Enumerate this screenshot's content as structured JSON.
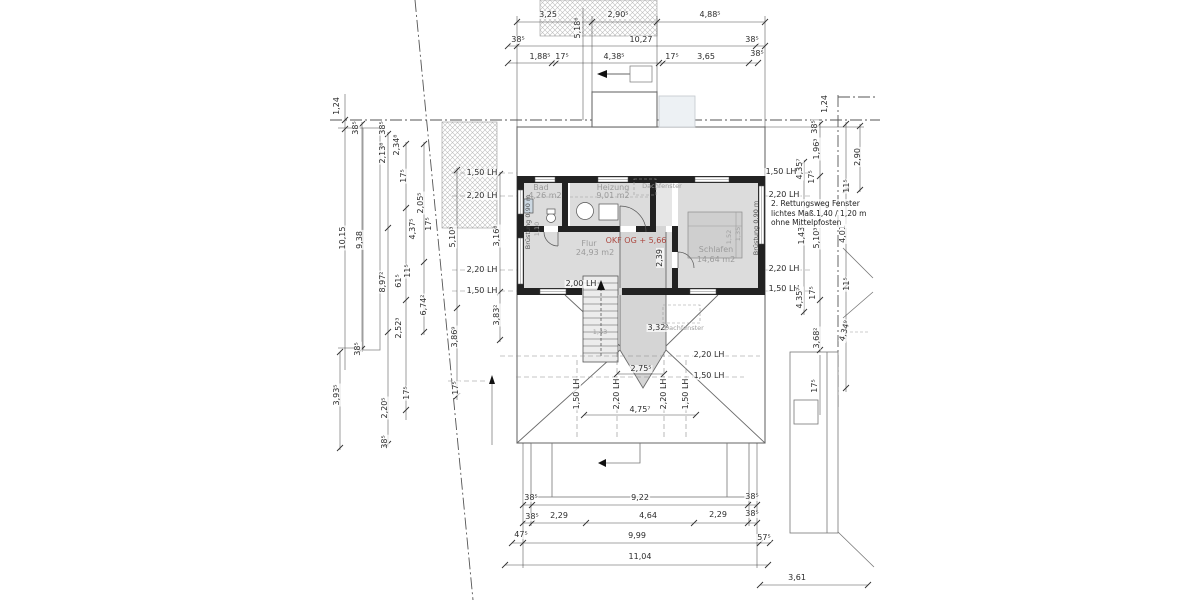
{
  "drawing": {
    "type": "floor-plan-obergeschoss",
    "level_marker": "OKF OG + 5,66",
    "rooms": [
      {
        "name": "Bad",
        "area": "4,26 m2"
      },
      {
        "name": "Heizung",
        "area": "9,01 m2"
      },
      {
        "name": "Flur",
        "area": "24,93 m2"
      },
      {
        "name": "Schlafen",
        "area": "14,64 m2"
      }
    ],
    "annotation": {
      "x": 771,
      "y": 199,
      "lines": [
        "2. Rettungsweg Fenster",
        "lichtes Maß.1,40 / 1,20 m",
        "ohne Mittelpfosten"
      ]
    }
  },
  "colors": {
    "line": "#4c4c4c",
    "wall": "#222222",
    "room_fill": "#dcdcdc",
    "level_red": "#ad4a42",
    "dim_text": "#2b2b2b",
    "room_text": "#9b9b9b"
  },
  "labels": [
    {
      "t": "3,25",
      "x": 548,
      "y": 15
    },
    {
      "t": "2,90⁵",
      "x": 618,
      "y": 15
    },
    {
      "t": "4,88⁵",
      "x": 710,
      "y": 15
    },
    {
      "t": "5,18⁶",
      "x": 578,
      "y": 28,
      "r": 90
    },
    {
      "t": "38⁵",
      "x": 518,
      "y": 40
    },
    {
      "t": "10,27",
      "x": 641,
      "y": 40
    },
    {
      "t": "38⁵",
      "x": 752,
      "y": 40
    },
    {
      "t": "1,88⁵",
      "x": 540,
      "y": 57
    },
    {
      "t": "17⁵",
      "x": 562,
      "y": 57
    },
    {
      "t": "4,38⁵",
      "x": 614,
      "y": 57
    },
    {
      "t": "17⁵",
      "x": 672,
      "y": 57
    },
    {
      "t": "3,65",
      "x": 706,
      "y": 57
    },
    {
      "t": "38⁵",
      "x": 757,
      "y": 54
    },
    {
      "t": "1,24",
      "x": 337,
      "y": 106,
      "r": 90
    },
    {
      "t": "38⁵",
      "x": 356,
      "y": 128,
      "r": 90
    },
    {
      "t": "38⁵",
      "x": 383,
      "y": 128,
      "r": 90
    },
    {
      "t": "2,13⁸",
      "x": 383,
      "y": 153,
      "r": 90
    },
    {
      "t": "2,34⁸",
      "x": 397,
      "y": 145,
      "r": 90
    },
    {
      "t": "17⁵",
      "x": 404,
      "y": 176,
      "r": 90
    },
    {
      "t": "2,05⁵",
      "x": 421,
      "y": 203,
      "r": 90
    },
    {
      "t": "17⁵",
      "x": 429,
      "y": 224,
      "r": 90
    },
    {
      "t": "4,37⁵",
      "x": 413,
      "y": 229,
      "r": 90
    },
    {
      "t": "10,15",
      "x": 343,
      "y": 238,
      "r": 90
    },
    {
      "t": "9,38",
      "x": 360,
      "y": 240,
      "r": 90
    },
    {
      "t": "5,10³",
      "x": 453,
      "y": 237,
      "r": 90
    },
    {
      "t": "3,16⁸",
      "x": 497,
      "y": 236,
      "r": 90
    },
    {
      "t": "8,97²",
      "x": 383,
      "y": 282,
      "r": 90
    },
    {
      "t": "61⁵",
      "x": 399,
      "y": 281,
      "r": 90
    },
    {
      "t": "11⁵",
      "x": 408,
      "y": 271,
      "r": 90
    },
    {
      "t": "6,74²",
      "x": 424,
      "y": 305,
      "r": 90
    },
    {
      "t": "2,52³",
      "x": 399,
      "y": 328,
      "r": 90
    },
    {
      "t": "38⁵",
      "x": 358,
      "y": 349,
      "r": 90
    },
    {
      "t": "3,83²",
      "x": 497,
      "y": 315,
      "r": 90
    },
    {
      "t": "3,86⁹",
      "x": 455,
      "y": 337,
      "r": 90
    },
    {
      "t": "3,93⁵",
      "x": 337,
      "y": 395,
      "r": 90
    },
    {
      "t": "2,20⁵",
      "x": 385,
      "y": 408,
      "r": 90
    },
    {
      "t": "38⁵",
      "x": 385,
      "y": 442,
      "r": 90
    },
    {
      "t": "17⁵",
      "x": 407,
      "y": 393,
      "r": 90
    },
    {
      "t": "17⁵",
      "x": 456,
      "y": 388,
      "r": 90
    },
    {
      "t": "1,50 LH",
      "x": 482,
      "y": 173
    },
    {
      "t": "2,20 LH",
      "x": 482,
      "y": 196
    },
    {
      "t": "2,20 LH",
      "x": 482,
      "y": 270
    },
    {
      "t": "1,50 LH",
      "x": 482,
      "y": 291
    },
    {
      "t": "2,00 LH",
      "x": 581,
      "y": 284
    },
    {
      "t": "1,43",
      "x": 600,
      "y": 332,
      "c": "tinyg"
    },
    {
      "t": "3,32²",
      "x": 658,
      "y": 328
    },
    {
      "t": "Dachfenster",
      "x": 684,
      "y": 328,
      "c": "tinyg"
    },
    {
      "t": "2,75⁵",
      "x": 641,
      "y": 369
    },
    {
      "t": "4,75⁷",
      "x": 640,
      "y": 410
    },
    {
      "t": "1,50 LH",
      "x": 577,
      "y": 394,
      "r": 90
    },
    {
      "t": "2,20 LH",
      "x": 617,
      "y": 394,
      "r": 90
    },
    {
      "t": "2,20 LH",
      "x": 664,
      "y": 394,
      "r": 90
    },
    {
      "t": "1,50 LH",
      "x": 686,
      "y": 394,
      "r": 90
    },
    {
      "t": "2,20 LH",
      "x": 709,
      "y": 355
    },
    {
      "t": "1,50 LH",
      "x": 709,
      "y": 376
    },
    {
      "t": "2,39",
      "x": 660,
      "y": 258,
      "r": 90
    },
    {
      "t": "Bad",
      "x": 541,
      "y": 188,
      "c": "room"
    },
    {
      "t": "4,26 m2",
      "x": 545,
      "y": 196,
      "c": "room"
    },
    {
      "t": "Heizung",
      "x": 613,
      "y": 188,
      "c": "room"
    },
    {
      "t": "9,01 m2",
      "x": 613,
      "y": 196,
      "c": "room"
    },
    {
      "t": "Dachfenster",
      "x": 662,
      "y": 186,
      "c": "tinyg"
    },
    {
      "t": "Flur",
      "x": 589,
      "y": 244,
      "c": "room"
    },
    {
      "t": "24,93 m2",
      "x": 595,
      "y": 253,
      "c": "room"
    },
    {
      "t": "OKF OG + 5,66",
      "x": 636,
      "y": 241,
      "c": "red"
    },
    {
      "t": "Schlafen",
      "x": 716,
      "y": 250,
      "c": "room"
    },
    {
      "t": "14,64 m2",
      "x": 716,
      "y": 260,
      "c": "room"
    },
    {
      "t": "Brüstung 0,90 m",
      "x": 528,
      "y": 222,
      "r": 90,
      "c": "tiny"
    },
    {
      "t": "Brüstung 0,90 m",
      "x": 756,
      "y": 228,
      "r": 90,
      "c": "tiny"
    },
    {
      "t": "1,10",
      "x": 537,
      "y": 229,
      "r": 90,
      "c": "tinyg"
    },
    {
      "t": "1,52",
      "x": 729,
      "y": 237,
      "r": 90,
      "c": "tinyg"
    },
    {
      "t": "1,35",
      "x": 738,
      "y": 234,
      "r": 90,
      "c": "tinyg"
    },
    {
      "t": "1,50 LH",
      "x": 781,
      "y": 172
    },
    {
      "t": "2,20 LH",
      "x": 784,
      "y": 195
    },
    {
      "t": "2,20 LH",
      "x": 784,
      "y": 269
    },
    {
      "t": "1,50 LH",
      "x": 784,
      "y": 289
    },
    {
      "t": "1,24",
      "x": 825,
      "y": 104,
      "r": 90
    },
    {
      "t": "38⁵",
      "x": 815,
      "y": 127,
      "r": 90
    },
    {
      "t": "1,96³",
      "x": 817,
      "y": 149,
      "r": 90
    },
    {
      "t": "2,90",
      "x": 858,
      "y": 157,
      "r": 90
    },
    {
      "t": "4,35⁷",
      "x": 800,
      "y": 169,
      "r": 90
    },
    {
      "t": "17⁵",
      "x": 812,
      "y": 177,
      "r": 90
    },
    {
      "t": "11⁵",
      "x": 847,
      "y": 186,
      "r": 90
    },
    {
      "t": "1,43⁵",
      "x": 802,
      "y": 234,
      "r": 90
    },
    {
      "t": "5,10³",
      "x": 817,
      "y": 238,
      "r": 90
    },
    {
      "t": "4,01",
      "x": 843,
      "y": 234,
      "r": 90
    },
    {
      "t": "11⁵",
      "x": 847,
      "y": 284,
      "r": 90
    },
    {
      "t": "4,35⁷",
      "x": 800,
      "y": 298,
      "r": 90
    },
    {
      "t": "17⁵",
      "x": 813,
      "y": 293,
      "r": 90
    },
    {
      "t": "3,68²",
      "x": 817,
      "y": 338,
      "r": 90
    },
    {
      "t": "4,34⁹",
      "x": 845,
      "y": 331,
      "r": 75
    },
    {
      "t": "17⁵",
      "x": 815,
      "y": 386,
      "r": 90
    },
    {
      "t": "38⁵",
      "x": 531,
      "y": 498
    },
    {
      "t": "9,22",
      "x": 640,
      "y": 498
    },
    {
      "t": "38⁵",
      "x": 752,
      "y": 497
    },
    {
      "t": "38⁵",
      "x": 532,
      "y": 517
    },
    {
      "t": "2,29",
      "x": 559,
      "y": 516
    },
    {
      "t": "4,64",
      "x": 648,
      "y": 516
    },
    {
      "t": "2,29",
      "x": 718,
      "y": 515
    },
    {
      "t": "38⁵",
      "x": 752,
      "y": 514
    },
    {
      "t": "47⁵",
      "x": 521,
      "y": 535
    },
    {
      "t": "9,99",
      "x": 637,
      "y": 536
    },
    {
      "t": "57⁵",
      "x": 764,
      "y": 538
    },
    {
      "t": "11,04",
      "x": 640,
      "y": 557
    },
    {
      "t": "3,61",
      "x": 797,
      "y": 578
    }
  ]
}
